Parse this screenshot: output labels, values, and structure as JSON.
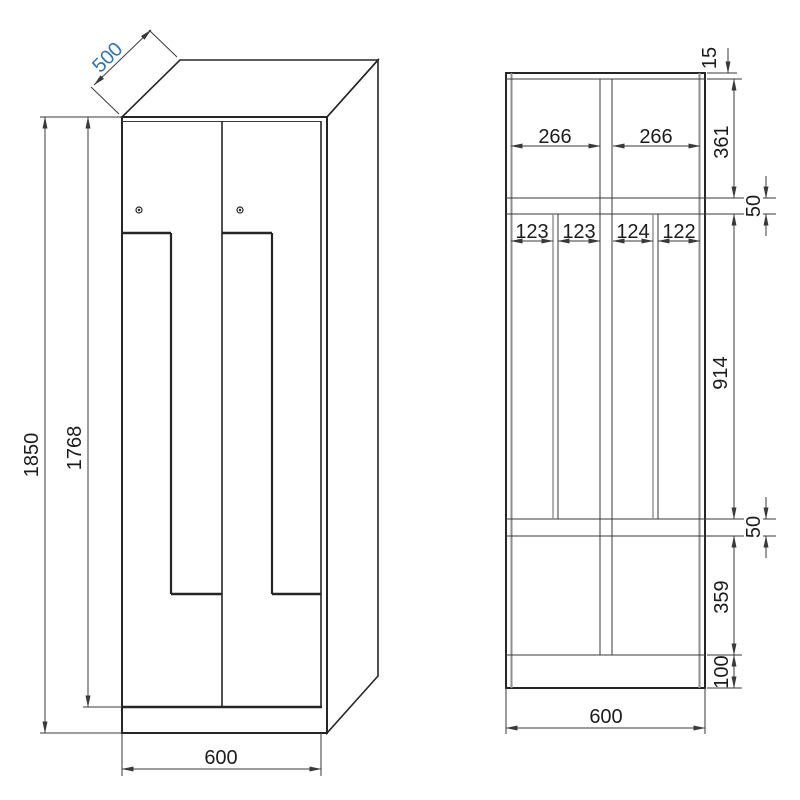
{
  "drawing": {
    "accent_color": "#2e74b5",
    "line_color": "#262626",
    "front_view": {
      "depth_label": "500",
      "height_label": "1850",
      "door_height_label": "1768",
      "width_label": "600"
    },
    "interior_view": {
      "top_panel_label": "15",
      "compartment_width_labels": [
        "266",
        "266"
      ],
      "hook_section_labels": [
        "123",
        "123",
        "124",
        "122"
      ],
      "top_compartment_height_label": "361",
      "shelf_thickness_labels": [
        "50",
        "50"
      ],
      "middle_section_height_label": "914",
      "bottom_compartment_height_label": "359",
      "plinth_height_label": "100",
      "width_label": "600"
    }
  }
}
